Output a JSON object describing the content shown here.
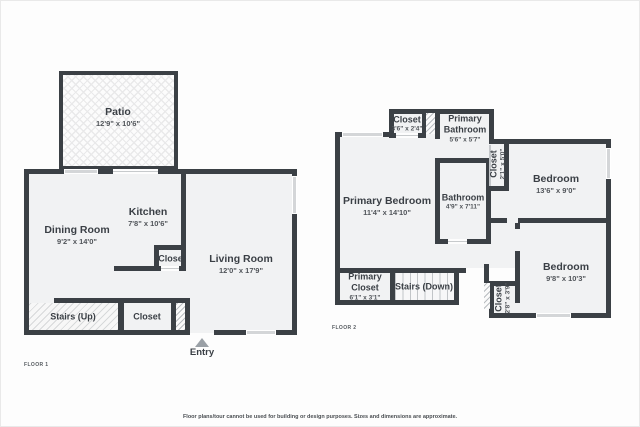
{
  "colors": {
    "wall": "#3b4045",
    "floor": "#f1f2f3",
    "window": "#d4d6d8"
  },
  "disclaimer": "Floor plans/tour cannot be used for building or design purposes. Sizes and dimensions are approximate.",
  "floor1": {
    "title": "FLOOR 1",
    "patio": {
      "name": "Patio",
      "dims": "12'9\" x 10'6\""
    },
    "dining_room": {
      "name": "Dining Room",
      "dims": "9'2\" x 14'0\""
    },
    "kitchen": {
      "name": "Kitchen",
      "dims": "7'8\" x 10'6\""
    },
    "living_room": {
      "name": "Living Room",
      "dims": "12'0\" x 17'9\""
    },
    "kitchen_closet": {
      "name": "Closet"
    },
    "stairs": {
      "name": "Stairs (Up)"
    },
    "entry_closet": {
      "name": "Closet"
    },
    "entry": {
      "name": "Entry"
    }
  },
  "floor2": {
    "title": "FLOOR 2",
    "top_closet": {
      "name": "Closet",
      "dims": "3'6\" x 2'4\""
    },
    "primary_bathroom": {
      "name_line1": "Primary",
      "name_line2": "Bathroom",
      "dims": "5'6\" x 5'7\""
    },
    "primary_bedroom": {
      "name": "Primary Bedroom",
      "dims": "11'4\" x 14'10\""
    },
    "bathroom": {
      "name": "Bathroom",
      "dims": "4'9\" x 7'11\""
    },
    "hall_closet": {
      "name": "Closet",
      "dims": "2'1\" x 5'0\""
    },
    "bedroom_top": {
      "name": "Bedroom",
      "dims": "13'6\" x 9'0\""
    },
    "bedroom_bottom": {
      "name": "Bedroom",
      "dims": "9'8\" x 10'3\""
    },
    "primary_closet": {
      "name_line1": "Primary",
      "name_line2": "Closet",
      "dims": "6'1\" x 3'1\""
    },
    "stairs": {
      "name": "Stairs (Down)"
    },
    "bottom_closet": {
      "name": "Closet",
      "dims": "2'8\" x 3'9\""
    }
  }
}
